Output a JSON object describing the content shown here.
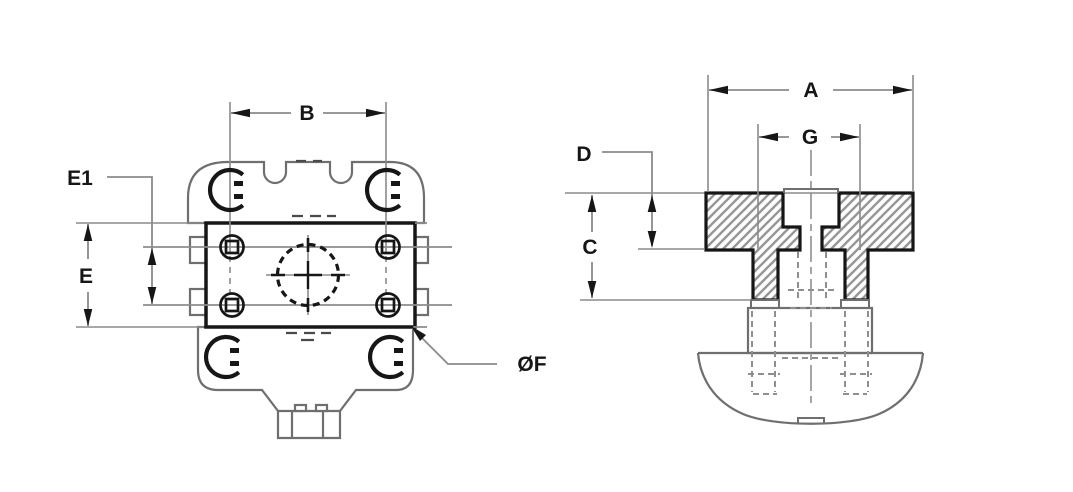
{
  "drawing": {
    "kind": "two-view technical dimension drawing",
    "labels": {
      "A": "A",
      "B": "B",
      "C": "C",
      "D": "D",
      "E": "E",
      "E1": "E1",
      "G": "G",
      "F_dia": "ØF"
    },
    "views": {
      "front": {
        "dimension_labels": [
          "B",
          "E1",
          "E",
          "ØF"
        ]
      },
      "section": {
        "dimension_labels": [
          "A",
          "G",
          "D",
          "C"
        ]
      }
    },
    "colors": {
      "background": "#ffffff",
      "part_line": "#161616",
      "body_line": "#6f6f6f",
      "dimension_line": "#8b8b8b",
      "hatch_line": "#979797"
    }
  }
}
